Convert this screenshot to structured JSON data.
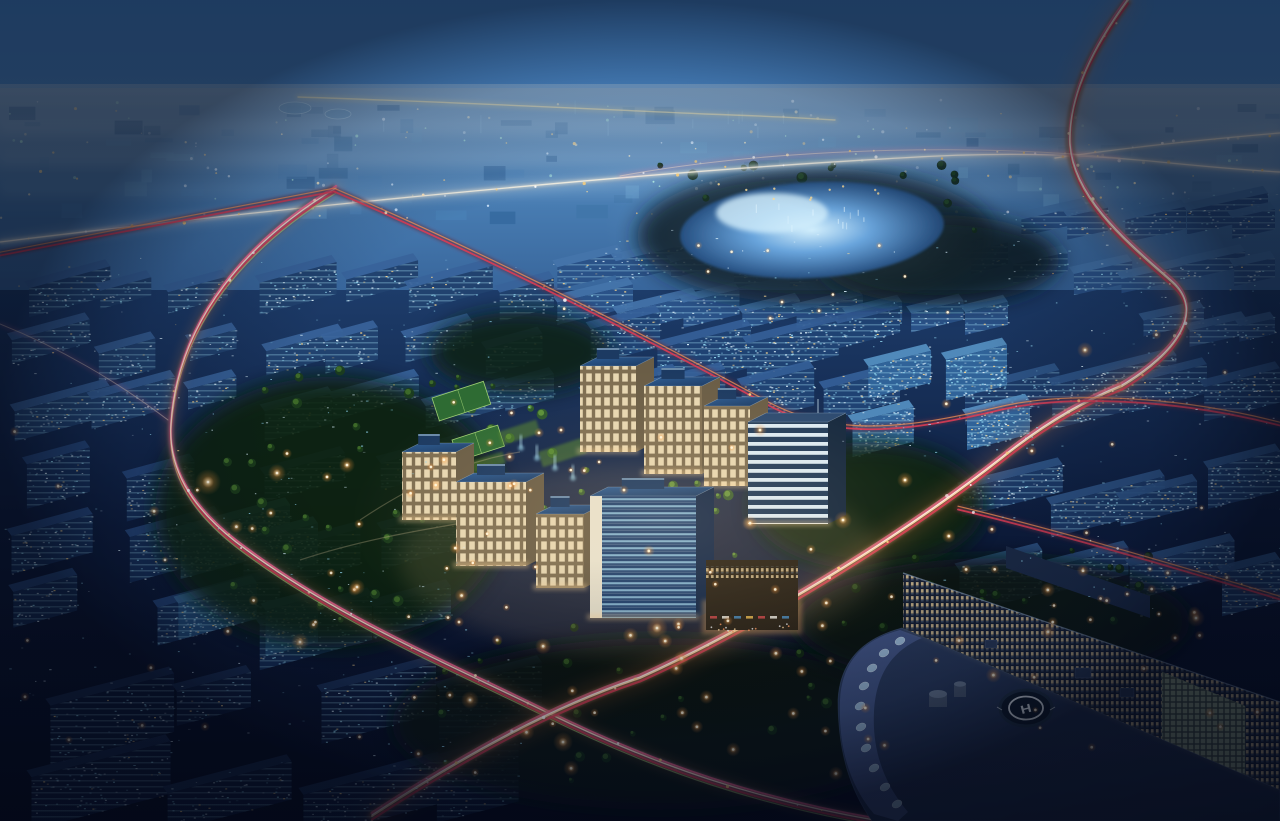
{
  "scene": {
    "description": "Dusk aerial rendering of a glowing office campus with warm stone buildings and blue glass roofs, surrounded by dark blue city blocks, ring roads with pink and orange car light trails, a pale elevated highway, a luminous lake, green parks with street lamps, and a curved hospital building with a rooftop helipad.",
    "time_of_day": "night"
  },
  "seed": 20240711,
  "helipad": {
    "letter": "H"
  },
  "palette": {
    "sky_top": "#4a8fd6",
    "sky_mid": "#5f9cd8",
    "horizon_haze": "#8fb8dc",
    "distant_hi": "#759fc8",
    "distant_md": "#4a7fb4",
    "distant_lo": "#29538a",
    "lower_hi": "#1d3c6a",
    "lower_md": "#0d1c3c",
    "lower_lo": "#060b1e",
    "lake_core": "#d6f0fc",
    "lake_mid": "#5e9cd8",
    "lake_deep": "#1c4578",
    "trail_pink": "#ff6b95",
    "trail_red": "#e23c55",
    "trail_orange": "#ff9a55",
    "trail_core": "#ffe7cf",
    "trail_green": "#b9d977",
    "lamp_core": "#fff3d6",
    "lamp_glow": "#ff9a3d",
    "facade_warm": "#f4e4be",
    "facade_shade": "#7e6e52",
    "glass_roof": "#2e5d94",
    "glass_roof_dark": "#1b3a63",
    "glass_slab": "#1d3f6e",
    "glass_stripe": "#9fd4ee",
    "stripe_band": "#dcebf4",
    "stripe_gap": "#223c5a",
    "hospital_roof": "#2e3f63",
    "hospital_roof_dark": "#1b2742",
    "hospital_rim": "#46598a",
    "skylight": "#a9cbe6",
    "helipad_pad": "#0f1a28",
    "helipad_mark": "#eef4f8",
    "window_cyan": "#8fd2ec",
    "window_pale": "#d6ecf8",
    "window_warm": "#ffd98f",
    "tree_green": "#0d2410",
    "tree_lit": "#4a7a2e"
  },
  "lake": {
    "cx": 812,
    "cy": 230,
    "rx": 132,
    "ry": 48,
    "core": [
      772,
      213,
      56,
      20
    ],
    "shore_lights": 10,
    "sparkles": 12
  },
  "distant": {
    "y0": 96,
    "y1": 214,
    "slabs": 88,
    "dots": 150,
    "spires": 10,
    "domes": [
      [
        295,
        108,
        16,
        6
      ],
      [
        338,
        114,
        13,
        5
      ]
    ]
  },
  "trails": [
    {
      "name": "elevated-highway",
      "style": "highway",
      "under": "pale",
      "lights": 22,
      "d": "M 0,242 C 260,210 640,172 900,158 C 1010,151 1090,155 1160,162 C 1200,166 1245,170 1280,172"
    },
    {
      "name": "highway-branch",
      "style": "highway",
      "under": "pale",
      "lights": 8,
      "d": "M 1055,158 C 1130,147 1210,139 1280,133"
    },
    {
      "name": "distant-lit-corridor",
      "style": "yellowfar",
      "under": "none",
      "lights": 0,
      "d": "M 298,97 C 450,102 570,108 705,114 C 765,116 805,118 835,120"
    },
    {
      "name": "west-ring-road",
      "style": "ring",
      "under": "dark",
      "lights": 18,
      "d": "M 336,188 C 250,240 178,318 171,424 C 168,468 190,506 236,542 C 330,614 440,660 546,712 C 660,768 762,801 880,821"
    },
    {
      "name": "main-boulevard",
      "style": "main",
      "under": "dark",
      "lights": 18,
      "d": "M 372,816 C 470,752 556,706 640,678 C 756,626 900,538 1002,458 C 1052,418 1092,398 1122,386"
    },
    {
      "name": "s-curve-road",
      "style": "main",
      "under": "dark",
      "lights": 12,
      "d": "M 1128,0 C 1095,45 1068,95 1070,145 C 1074,200 1130,245 1172,282 C 1206,312 1176,354 1122,386"
    },
    {
      "name": "red-artery-west",
      "style": "red",
      "under": "thin",
      "lights": 0,
      "d": "M 0,254 C 112,232 232,210 334,190"
    },
    {
      "name": "red-artery-east",
      "style": "red",
      "under": "thin",
      "lights": 6,
      "d": "M 334,190 C 470,248 610,318 758,398 C 828,440 902,432 1002,408 C 1064,394 1170,396 1280,424"
    },
    {
      "name": "hospital-front-road",
      "style": "red",
      "under": "thin",
      "lights": 4,
      "d": "M 958,508 C 1050,530 1160,562 1280,598"
    },
    {
      "name": "west-park-branch",
      "style": "faint",
      "under": "none",
      "lights": 0,
      "d": "M 0,324 C 60,348 118,382 168,420"
    },
    {
      "name": "north-lake-arc",
      "style": "faint",
      "under": "none",
      "lights": 10,
      "d": "M 620,176 C 760,150 960,142 1120,158"
    }
  ],
  "city_regions": [
    {
      "name": "north-band",
      "x": 548,
      "y": 230,
      "w": 460,
      "h": 96,
      "rows": 2,
      "cols": 8,
      "sw": [
        44,
        92
      ],
      "sh": [
        14,
        26
      ],
      "s": 0.24,
      "fill": "#2a5288",
      "roof": "#4474aa",
      "glint": 0.02
    },
    {
      "name": "campus-north-glass",
      "x": 560,
      "y": 300,
      "w": 340,
      "h": 108,
      "rows": 2,
      "cols": 4,
      "sw": [
        60,
        100
      ],
      "sh": [
        24,
        42
      ],
      "s": 0.25,
      "fill": "#1f4273",
      "roof": "#356098",
      "glint": 0.035
    },
    {
      "name": "lake-east",
      "x": 1005,
      "y": 185,
      "w": 270,
      "h": 110,
      "rows": 2,
      "cols": 5,
      "sw": [
        40,
        84
      ],
      "sh": [
        14,
        24
      ],
      "s": 0.22,
      "fill": "#2c558c",
      "roof": "#4778ae",
      "glint": 0.016
    },
    {
      "name": "mid-left",
      "x": 4,
      "y": 250,
      "w": 550,
      "h": 175,
      "rows": 3,
      "cols": 7,
      "sw": [
        46,
        105
      ],
      "sh": [
        18,
        34
      ],
      "s": 0.27,
      "fill": "#21426f",
      "roof": "#38639a",
      "glint": 0.022
    },
    {
      "name": "right-mid",
      "x": 935,
      "y": 335,
      "w": 345,
      "h": 290,
      "rows": 3,
      "cols": 4,
      "sw": [
        64,
        128
      ],
      "sh": [
        24,
        44
      ],
      "s": 0.25,
      "fill": "#1c3a68",
      "roof": "#30578a",
      "glint": 0.03
    },
    {
      "name": "far-right-top",
      "x": 1125,
      "y": 298,
      "w": 150,
      "h": 62,
      "rows": 1,
      "cols": 3,
      "sw": [
        38,
        72
      ],
      "sh": [
        14,
        22
      ],
      "s": 0.22,
      "fill": "#25497c",
      "roof": "#3a6496",
      "glint": 0.02
    },
    {
      "name": "ne-glass",
      "x": 845,
      "y": 328,
      "w": 185,
      "h": 125,
      "rows": 2,
      "cols": 2,
      "sw": [
        58,
        95
      ],
      "sh": [
        30,
        48
      ],
      "s": 0.25,
      "fill": "#306399",
      "roof": "#5590c2",
      "glint": 0.06
    },
    {
      "name": "left-low",
      "x": 2,
      "y": 430,
      "w": 460,
      "h": 200,
      "rows": 3,
      "cols": 4,
      "sw": [
        62,
        128
      ],
      "sh": [
        26,
        48
      ],
      "s": 0.27,
      "fill": "#16305a",
      "roof": "#284b80",
      "glint": 0.02
    },
    {
      "name": "west-glass",
      "x": 168,
      "y": 492,
      "w": 150,
      "h": 140,
      "rows": 2,
      "cols": 2,
      "sw": [
        70,
        110
      ],
      "sh": [
        36,
        52
      ],
      "s": 0.27,
      "fill": "#24517f",
      "roof": "#3f74a4",
      "glint": 0.05
    },
    {
      "name": "foreground",
      "x": 2,
      "y": 628,
      "w": 540,
      "h": 188,
      "rows": 2,
      "cols": 4,
      "sw": [
        72,
        150
      ],
      "sh": [
        32,
        62
      ],
      "s": 0.26,
      "fill": "#0e1d3e",
      "roof": "#1c3259",
      "glint": 0.012
    }
  ],
  "glint_regions": [
    {
      "x": 0,
      "y": 250,
      "w": 560,
      "h": 180,
      "count": 90
    },
    {
      "x": 940,
      "y": 330,
      "w": 340,
      "h": 290,
      "count": 85
    },
    {
      "x": 550,
      "y": 228,
      "w": 460,
      "h": 100,
      "count": 60
    },
    {
      "x": 1000,
      "y": 185,
      "w": 280,
      "h": 118,
      "count": 50
    },
    {
      "x": 0,
      "y": 428,
      "w": 470,
      "h": 210,
      "count": 70
    },
    {
      "x": 0,
      "y": 636,
      "w": 540,
      "h": 182,
      "count": 95
    },
    {
      "x": 1120,
      "y": 296,
      "w": 160,
      "h": 66,
      "count": 25
    },
    {
      "x": 838,
      "y": 326,
      "w": 200,
      "h": 130,
      "count": 45
    }
  ],
  "tree_blobs": [
    [
      815,
      236,
      178,
      68,
      "#081a26"
    ],
    [
      660,
      724,
      268,
      86,
      "#081808"
    ],
    [
      330,
      512,
      175,
      135,
      "#0d2410"
    ],
    [
      868,
      506,
      116,
      64,
      "#0a2010"
    ],
    [
      992,
      622,
      198,
      64,
      "#071608"
    ],
    [
      520,
      352,
      90,
      40,
      "#0c2212"
    ],
    [
      940,
      260,
      120,
      45,
      "#081a20"
    ]
  ],
  "tree_regions": [
    {
      "x": 470,
      "y": 408,
      "w": 266,
      "h": 150,
      "count": 42,
      "c1": "#2d5c28",
      "c2": "#6ba33e"
    },
    {
      "x": 215,
      "y": 370,
      "w": 300,
      "h": 255,
      "count": 34,
      "c1": "#1c3d1c",
      "c2": "#4a7a2e"
    },
    {
      "x": 430,
      "y": 620,
      "w": 470,
      "h": 165,
      "count": 30,
      "c1": "#122a12",
      "c2": "#3a6126"
    },
    {
      "x": 660,
      "y": 165,
      "w": 330,
      "h": 70,
      "count": 24,
      "c1": "#0c2413",
      "c2": "#1e4420"
    },
    {
      "x": 850,
      "y": 545,
      "w": 300,
      "h": 100,
      "count": 18,
      "c1": "#0e2410",
      "c2": "#2c5222"
    }
  ],
  "park": {
    "courts": [
      [
        432,
        398,
        54,
        24
      ],
      [
        452,
        440,
        48,
        22
      ]
    ],
    "lawns": [
      [
        498,
        432,
        40,
        14
      ],
      [
        538,
        452,
        46,
        16
      ],
      [
        470,
        462,
        34,
        12
      ]
    ],
    "fountains": [
      [
        520,
        448
      ],
      [
        536,
        458
      ],
      [
        554,
        468
      ],
      [
        572,
        478
      ]
    ],
    "paths": [
      "M 360,520 C 420,480 470,460 520,452",
      "M 300,560 C 360,540 420,530 480,520"
    ]
  },
  "campus_buildings": [
    {
      "kind": "warm",
      "x": 580,
      "y": 366,
      "w": 56,
      "h": 86
    },
    {
      "kind": "warm",
      "x": 644,
      "y": 386,
      "w": 58,
      "h": 88
    },
    {
      "kind": "warm",
      "x": 704,
      "y": 406,
      "w": 46,
      "h": 80
    },
    {
      "kind": "stripe",
      "x": 748,
      "y": 422,
      "w": 80,
      "h": 102
    },
    {
      "kind": "warm",
      "x": 402,
      "y": 452,
      "w": 54,
      "h": 68
    },
    {
      "kind": "warm",
      "x": 456,
      "y": 482,
      "w": 70,
      "h": 84
    },
    {
      "kind": "warm",
      "x": 536,
      "y": 514,
      "w": 48,
      "h": 74
    },
    {
      "kind": "glass",
      "x": 590,
      "y": 496,
      "w": 106,
      "h": 122
    },
    {
      "kind": "retail",
      "x": 706,
      "y": 560,
      "w": 92,
      "h": 70
    }
  ],
  "hospital": {
    "back_wing": "1006,546 1150,596 1150,618 1006,568",
    "facade": "903,573 1280,702 1280,790 903,628",
    "parapet": [
      "903,573",
      "1280,702"
    ],
    "atrium": "1162,672 1245,706 1245,788 1162,740",
    "roof_plate": "M 838,700 C 840,660 864,638 902,628 L 1280,790 L 1280,821 L 872,821 C 850,790 838,752 838,700 Z",
    "rim_band": "M 900,630 C 862,640 842,662 840,700 C 838,748 850,786 874,814 L 898,821 L 908,812 C 884,784 872,750 874,712 C 876,672 894,650 922,638 Z",
    "skylights": [
      [
        900,
        641
      ],
      [
        884,
        653
      ],
      [
        872,
        668
      ],
      [
        864,
        686
      ],
      [
        860,
        706
      ],
      [
        861,
        727
      ],
      [
        866,
        748
      ],
      [
        874,
        768
      ],
      [
        885,
        787
      ],
      [
        897,
        804
      ]
    ],
    "helipad": {
      "cx": 1026,
      "cy": 708,
      "rx": 26,
      "ry": 18,
      "ring_rx": 17,
      "ring_ry": 11.5
    },
    "cylinders": [
      [
        938,
        694,
        9
      ],
      [
        960,
        684,
        6
      ]
    ],
    "roof_boxes": [
      [
        1075,
        668,
        16,
        10
      ],
      [
        1120,
        688,
        14,
        9
      ],
      [
        985,
        640,
        12,
        8
      ]
    ]
  },
  "lamp_regions": [
    {
      "x": 215,
      "y": 380,
      "w": 300,
      "h": 245,
      "count": 22,
      "r": [
        3.5,
        7
      ]
    },
    {
      "x": 480,
      "y": 420,
      "w": 255,
      "h": 155,
      "count": 13,
      "r": [
        3,
        5.5
      ]
    },
    {
      "x": 430,
      "y": 618,
      "w": 460,
      "h": 175,
      "count": 26,
      "r": [
        4,
        8
      ]
    },
    {
      "x": 640,
      "y": 510,
      "w": 420,
      "h": 170,
      "count": 16,
      "r": [
        4,
        8
      ]
    },
    {
      "x": 880,
      "y": 556,
      "w": 320,
      "h": 110,
      "count": 10,
      "r": [
        3.5,
        6.5
      ]
    },
    {
      "x": 10,
      "y": 430,
      "w": 450,
      "h": 370,
      "count": 20,
      "r": [
        3,
        6
      ]
    },
    {
      "x": 945,
      "y": 330,
      "w": 330,
      "h": 290,
      "count": 18,
      "r": [
        3,
        6
      ]
    },
    {
      "x": 555,
      "y": 238,
      "w": 440,
      "h": 88,
      "count": 12,
      "r": [
        2.5,
        4.5
      ]
    },
    {
      "x": 1010,
      "y": 640,
      "w": 260,
      "h": 150,
      "count": 8,
      "r": [
        3,
        6
      ]
    }
  ],
  "feature_lamps": [
    [
      208,
      482,
      13
    ],
    [
      657,
      628,
      11
    ],
    [
      563,
      742,
      10
    ],
    [
      843,
      520,
      9
    ],
    [
      300,
      642,
      9
    ],
    [
      1196,
      618,
      9
    ],
    [
      470,
      700,
      9
    ],
    [
      905,
      480,
      8
    ],
    [
      760,
      430,
      7
    ],
    [
      1085,
      350,
      8
    ],
    [
      277,
      473,
      9
    ],
    [
      347,
      465,
      8
    ],
    [
      357,
      587,
      8
    ]
  ]
}
